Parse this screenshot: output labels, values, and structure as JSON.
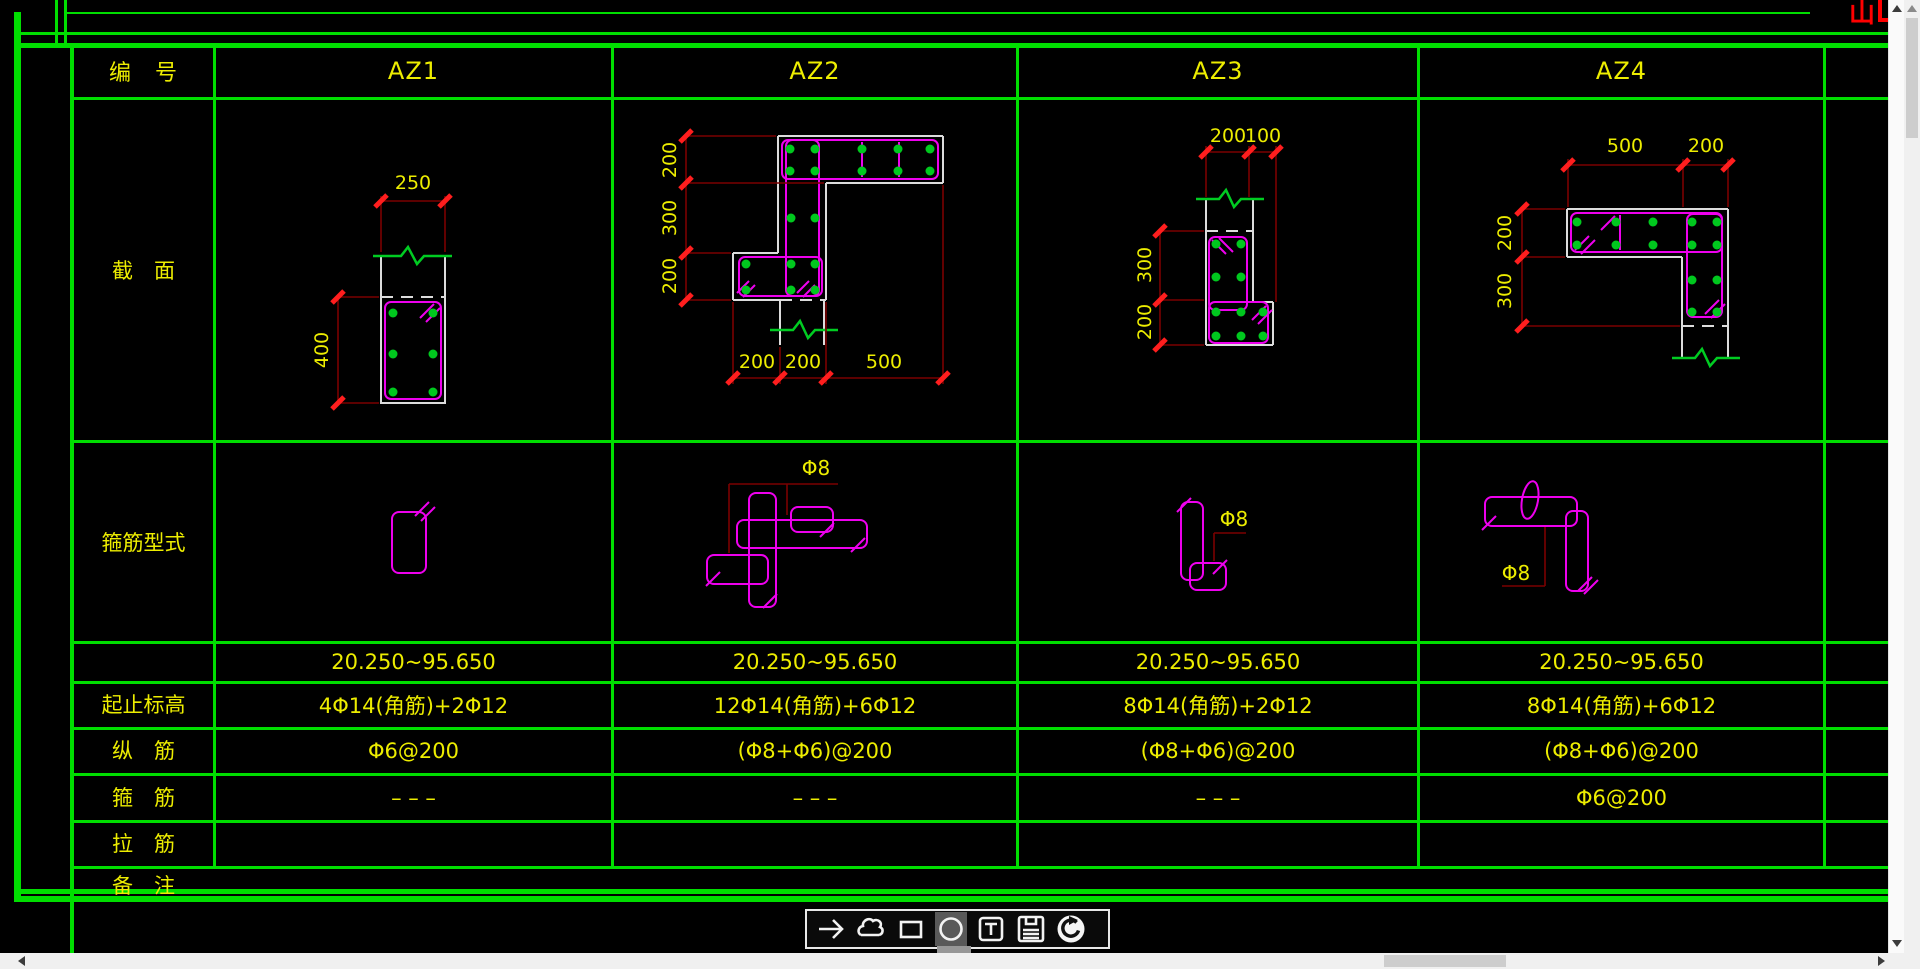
{
  "titlebar": {
    "top_right_text": "山"
  },
  "table": {
    "header": {
      "label": "编　号",
      "columns": [
        "AZ1",
        "AZ2",
        "AZ3",
        "AZ4"
      ]
    },
    "row_labels": {
      "section": "截　面",
      "stirrup_type": "箍筋型式",
      "elevation": "起止标高",
      "longitudinal": "纵　筋",
      "stirrup": "箍　筋",
      "tie": "拉　筋",
      "remark": "备　注"
    },
    "values": {
      "elevation": [
        "20.250~95.650",
        "20.250~95.650",
        "20.250~95.650",
        "20.250~95.650"
      ],
      "longitudinal": [
        "4Φ14(角筋)+2Φ12",
        "12Φ14(角筋)+6Φ12",
        "8Φ14(角筋)+2Φ12",
        "8Φ14(角筋)+6Φ12"
      ],
      "stirrup": [
        "Φ6@200",
        "(Φ8+Φ6)@200",
        "(Φ8+Φ6)@200",
        "(Φ8+Φ6)@200"
      ],
      "tie": [
        "– – –",
        "– – –",
        "– – –",
        "Φ6@200"
      ],
      "remark": [
        "",
        "",
        "",
        ""
      ]
    }
  },
  "sections": {
    "az1": {
      "dim_top": "250",
      "dim_left": "400"
    },
    "az2": {
      "dims_left": [
        "200",
        "300",
        "200"
      ],
      "dims_bottom": [
        "200",
        "200",
        "500"
      ],
      "stirrup_label": "Φ8"
    },
    "az3": {
      "dims_top": [
        "200",
        "100"
      ],
      "dims_left": [
        "300",
        "200"
      ],
      "stirrup_label": "Φ8"
    },
    "az4": {
      "dims_top": [
        "500",
        "200"
      ],
      "dims_left": [
        "200",
        "300"
      ],
      "stirrup_label": "Φ8"
    }
  },
  "toolbar": {
    "icons": [
      "arrow-right",
      "cloud",
      "rectangle",
      "circle",
      "text",
      "save",
      "undo"
    ],
    "active_icon": "circle"
  },
  "colors": {
    "grid_green": "#00DE00",
    "text_yellow": "#EDED00",
    "dim_line_dark_red": "#7A0000",
    "tick_red": "#FF1E1E",
    "outline_white": "#DCDCDC",
    "stirrup_magenta": "#EE00EE",
    "rebar_green": "#00C81E",
    "title_red": "#FF0000"
  }
}
